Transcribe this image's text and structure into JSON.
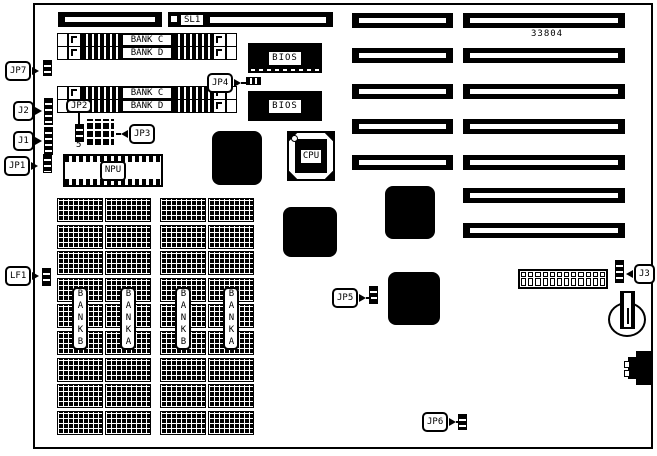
{
  "colors": {
    "ink": "#000000",
    "paper": "#ffffff"
  },
  "part_number": "33804",
  "slots": {
    "sl1": "SL1"
  },
  "simm": {
    "rows": [
      "BANK C",
      "BANK D",
      "BANK C",
      "BANK D"
    ]
  },
  "chips": {
    "bios": "BIOS",
    "cpu": "CPU",
    "npu": "NPU"
  },
  "memory": {
    "bank_labels": [
      "BANKB",
      "BANKA",
      "BANKB",
      "BANKA"
    ]
  },
  "jumpers": {
    "jp7": "JP7",
    "j2": "J2",
    "j1": "J1",
    "jp1": "JP1",
    "jp2": "JP2",
    "jp2_pin": "5",
    "jp3": "JP3",
    "jp4": "JP4",
    "jp5": "JP5",
    "jp6": "JP6",
    "j3": "J3",
    "lf1": "LF1"
  }
}
